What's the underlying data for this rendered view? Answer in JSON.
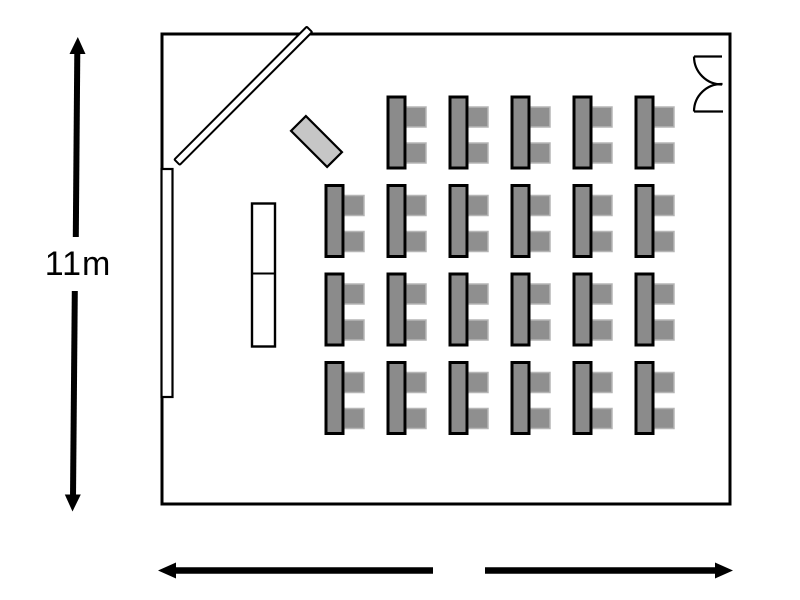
{
  "diagram_type": "classroom-floor-plan",
  "labels": {
    "room_depth": "11m"
  },
  "colors": {
    "wall": "#000000",
    "background": "#ffffff",
    "desk_fill": "#8b8b8b",
    "desk_border": "#000000",
    "chair_fill": "#8f8f8f",
    "chair_border": "#b5b5b5",
    "teacher_desk_fill": "#c6c6c6",
    "screen_fill": "#ffffff",
    "whiteboard_fill": "#ffffff",
    "lectern_fill": "#ffffff"
  },
  "furniture": {
    "desk_grid": {
      "rows": 4,
      "cols": 6,
      "origin": {
        "x": 326,
        "y": 97
      },
      "col_spacing": 62,
      "row_spacing": 88.5,
      "desk_size": {
        "w": 17,
        "h": 71
      },
      "chair_size": {
        "w": 20,
        "h": 20
      },
      "chair_offsets_y": [
        10,
        46
      ],
      "chairs_per_desk": 2,
      "skip_cells": [
        {
          "row": 0,
          "col": 0
        }
      ],
      "desk_count": 23,
      "seat_count": 46
    },
    "items": [
      {
        "name": "whiteboard",
        "location": "left-wall"
      },
      {
        "name": "projection-screen",
        "location": "top-left-corner-diagonal"
      },
      {
        "name": "teacher-desk",
        "location": "front-angled"
      },
      {
        "name": "lectern",
        "location": "front-left"
      },
      {
        "name": "double-door",
        "location": "top-right-wall"
      }
    ]
  },
  "dimension_arrows": {
    "vertical": {
      "label": "11m",
      "side": "left"
    },
    "horizontal": {
      "label": "",
      "side": "bottom",
      "segments": 2
    }
  }
}
